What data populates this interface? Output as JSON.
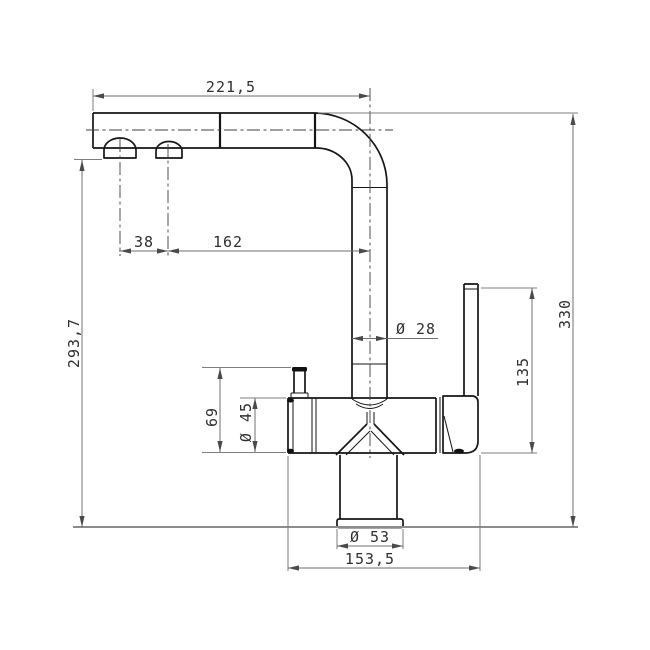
{
  "drawing": {
    "kind": "technical-dimension-drawing",
    "subject": "single-lever kitchen faucet with L-shaped swivel spout, side elevation",
    "units": "mm",
    "colors": {
      "background": "#ffffff",
      "object_line": "#161616",
      "dimension_line": "#6f6f6f",
      "centerline": "#3f3f3f",
      "text": "#2f2f2f"
    },
    "dims": {
      "spout_reach": "221,5",
      "aerator_offset": "38",
      "aerator_to_riser_axis": "162",
      "outlet_height": "293,7",
      "overall_height": "330",
      "riser_diameter": "Ø 28",
      "handle_height": "135",
      "body_top_height": "69",
      "body_diameter": "Ø 45",
      "base_diameter": "Ø 53",
      "overall_depth": "153,5"
    }
  }
}
